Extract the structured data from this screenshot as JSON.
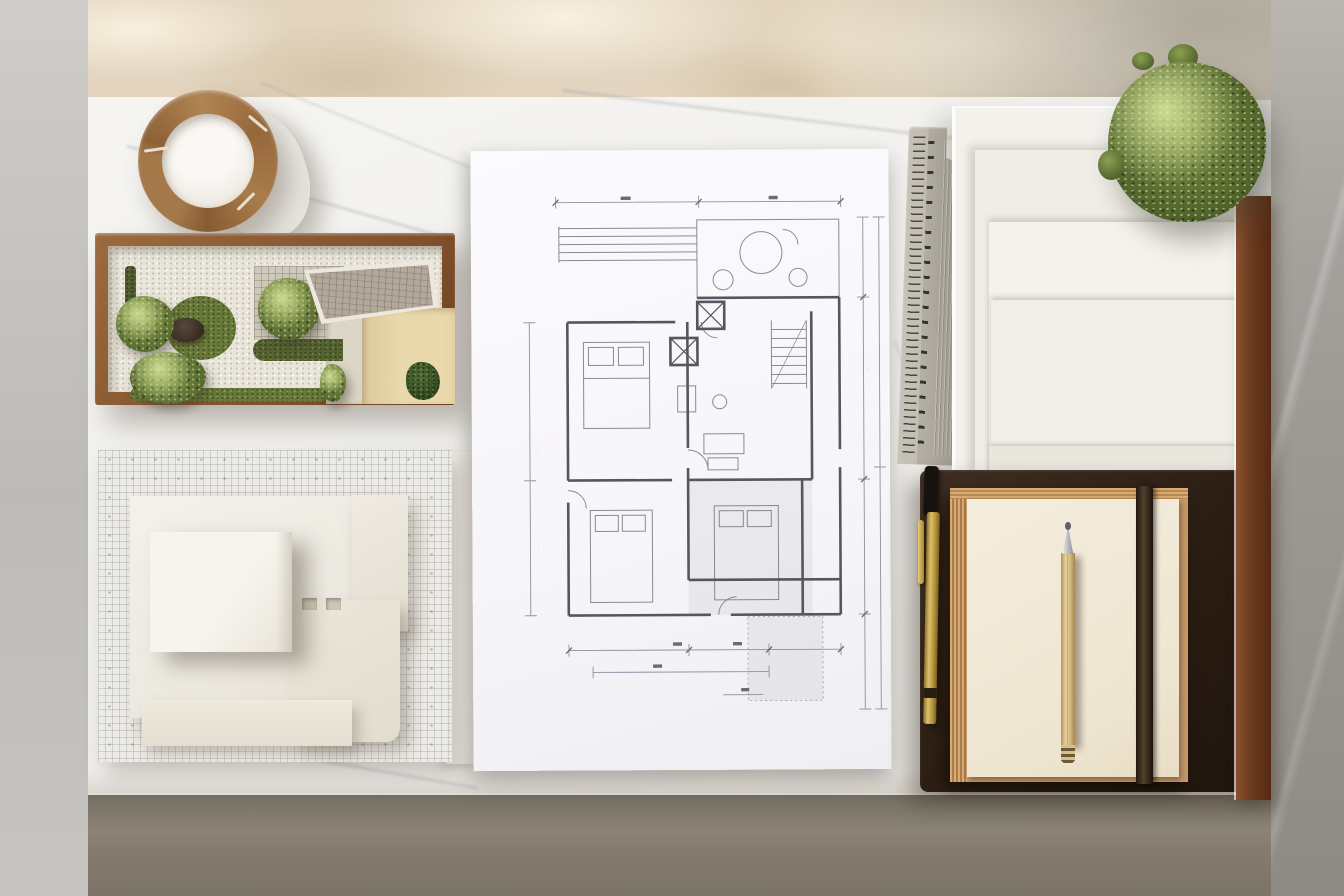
{
  "scene": {
    "type": "photograph",
    "view": "top-down flat lay",
    "setting": "architect's white marble studio desk against a warm sunlit wall with dappled foliage shadows; gray concrete floor below and gray marble wall at right",
    "lighting": "soft daylight from upper left, leaf-shadow dapple on the wall band at top",
    "text_legibility": "all drawing annotations and ruler numerals are too small to read; no legible text in image",
    "objects": [
      {
        "name": "wooden-ring-organizer",
        "description": "segmented round wooden ring resting on a white ceramic cylinder at the desk's top-left edge",
        "colors": [
          "#a5784a",
          "#f6f3ee"
        ]
      },
      {
        "name": "garden-diorama",
        "description": "walnut-framed miniature courtyard garden: white gravel, round moss lawn with dark rock, four shrubs, clipped hedge, gray tiled court, shingled roof canopy, beige patio with small plant",
        "colors": [
          "#8a5a33",
          "#e9e5da",
          "#68793a",
          "#b2a99b",
          "#e8d8ac"
        ]
      },
      {
        "name": "massing-model",
        "description": "white architectural massing model of stacked rectangular volumes on a gridded mosaic site board",
        "colors": [
          "#f4f1ea",
          "#edebe5"
        ]
      },
      {
        "name": "floor-plan-drawing",
        "description": "hand-drafted residential floor plan on white paper: deck lines, patio with round table, stair run, three bedrooms with beds, crossed closet boxes, shaded terrace, dimension chains on all sides",
        "colors": [
          "#fbfafc",
          "#5c5c66",
          "#8a8a94"
        ]
      },
      {
        "name": "metal-ruler",
        "description": "gray metal ruler with fine tick marks and fluted grip, notched top corner",
        "colors": [
          "#c6c1b7"
        ]
      },
      {
        "name": "paper-tray-stack",
        "description": "stepped stack of white paper trays and large blank sheets at top right",
        "colors": [
          "#f3f1ec"
        ]
      },
      {
        "name": "topiary-plant",
        "description": "round clipped green topiary shrub at the corner of the tray stack",
        "colors": [
          "#55682f"
        ]
      },
      {
        "name": "walnut-rail",
        "description": "dark walnut wood rail running down the right edge of the desk organizers",
        "colors": [
          "#6b3a1f"
        ]
      },
      {
        "name": "leather-desk-pad",
        "description": "dark chocolate leather pad at bottom right",
        "colors": [
          "#2a1d13"
        ]
      },
      {
        "name": "sketch-pad",
        "description": "cream sketch pad with kraft page edges and a dark brown elastic closure band",
        "colors": [
          "#f4eddd",
          "#c69a68",
          "#3b2b1d"
        ]
      },
      {
        "name": "wooden-pencil",
        "description": "natural wood drafting pencil with silver conical tip, laid vertically on the pad",
        "colors": [
          "#d5bb82",
          "#aeb1b5"
        ]
      },
      {
        "name": "brass-pen",
        "description": "brass pen with clip and dark cap lying along the pad's left edge",
        "colors": [
          "#c7a545",
          "#16130e"
        ]
      }
    ],
    "palette": {
      "wall_warm": "#e3d5bf",
      "wall_gray": "#98958f",
      "floor_gray": "#bdbbb7",
      "floor_taupe": "#847c6e",
      "desk_marble": "#f1f0ed",
      "plan_ink": "#5c5c66"
    }
  }
}
